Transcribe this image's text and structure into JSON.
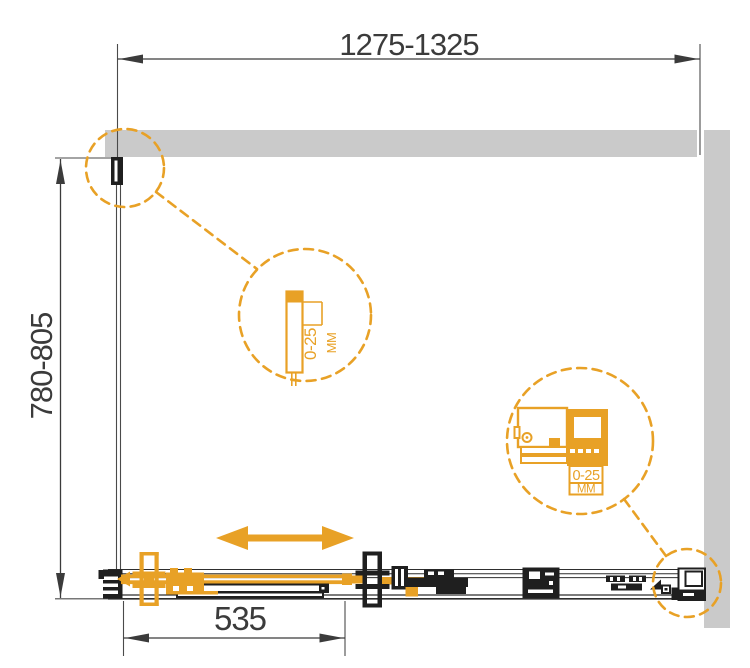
{
  "drawing": {
    "type": "shower-enclosure-installation-plan",
    "colors": {
      "accent_orange": "#E8A126",
      "wall_gray": "#CACACA",
      "hardware_black": "#1F1F1F",
      "dimension_gray": "#3B3B3B",
      "background": "#FFFFFF"
    },
    "dimensions": {
      "overall_width": "1275-1325",
      "overall_depth": "780-805",
      "door_width": "535"
    },
    "details": {
      "wall_profile_adjustment": {
        "range": "0-25",
        "unit": "ММ"
      },
      "roller_adjustment": {
        "range": "0-25",
        "unit": "ММ"
      }
    },
    "icons": {
      "slide_direction": "double-headed-arrow",
      "detail_callouts": "dashed-circle-magnifiers"
    }
  }
}
